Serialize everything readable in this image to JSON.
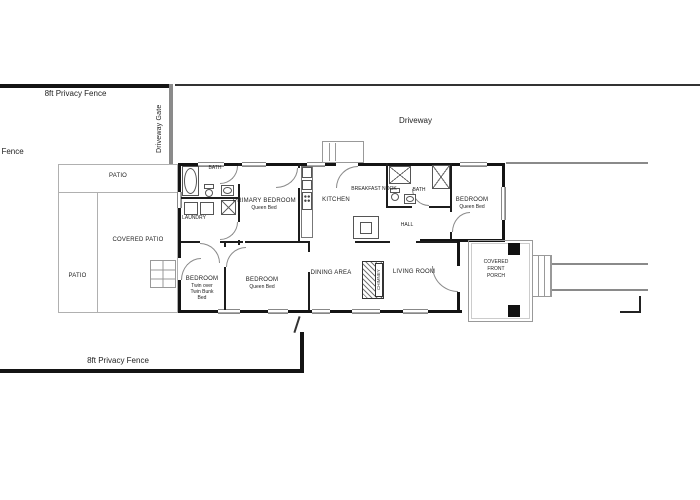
{
  "site": {
    "fence_top": "8ft Privacy Fence",
    "fence_left": "Privacy Fence",
    "fence_bottom": "8ft Privacy Fence",
    "driveway_gate": "Driveway Gate",
    "driveway": "Driveway",
    "patio_top": "PATIO",
    "patio_side": "PATIO",
    "covered_patio": "COVERED PATIO"
  },
  "rooms": {
    "bath1": "BATH",
    "laundry": "LAUNDRY",
    "primary": "PRIMARY BEDROOM",
    "primary_bed": "Queen Bed",
    "kitchen": "KITCHEN",
    "nook": "BREAKFAST NOOK",
    "bath2": "BATH",
    "hall": "HALL",
    "bed_back": "BEDROOM",
    "bed_back_bed": "Queen Bed",
    "bunk": "BEDROOM",
    "bunk_line1": "Twin over",
    "bunk_line2": "Twin Bunk",
    "bunk_line3": "Bed",
    "bed_front": "BEDROOM",
    "bed_front_bed": "Queen Bed",
    "dining": "DINING AREA",
    "living": "LIVING ROOM",
    "chimney": "CHIMNEY",
    "porch1": "COVERED",
    "porch2": "FRONT",
    "porch3": "PORCH"
  },
  "colors": {
    "wall": "#141414",
    "site_line": "#b0b0b0",
    "gate": "#8a8a8a",
    "text": "#222222"
  }
}
